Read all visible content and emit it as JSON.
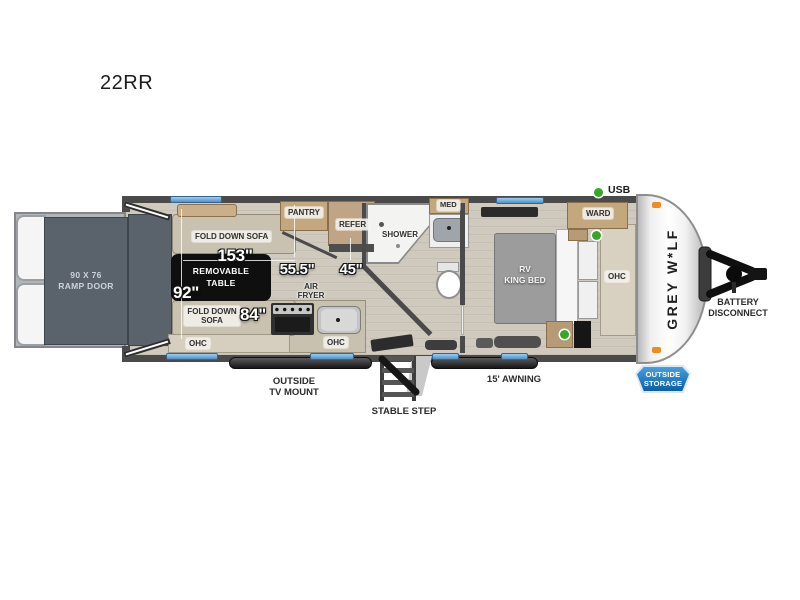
{
  "title": "22RR",
  "colors": {
    "window_blue": "#5f9fd4",
    "usb_green": "#35a829",
    "storage_badge_blue": "#1672c0",
    "marker_orange": "#f08c1e",
    "ramp_panel_gray": "#5a626b",
    "wall_gray": "#4a4a4a"
  },
  "dims": {
    "sofa_top": "153\"",
    "slide": "92\"",
    "sofa_bottom": "84\"",
    "galley": "55.5\"",
    "entry": "45\""
  },
  "living": {
    "sofa_top": "FOLD DOWN SOFA",
    "table_l1": "REMOVABLE",
    "table_l2": "TABLE",
    "sofa_bottom_l1": "FOLD DOWN",
    "sofa_bottom_l2": "SOFA",
    "ohc": "OHC"
  },
  "kitchen": {
    "pantry": "PANTRY",
    "refer": "REFER",
    "air_l1": "AIR",
    "air_l2": "FRYER",
    "ohc": "OHC"
  },
  "bath": {
    "shower": "SHOWER",
    "med": "MED"
  },
  "bedroom": {
    "bed_l1": "RV",
    "bed_l2": "KING BED",
    "ward": "WARD",
    "ohc": "OHC"
  },
  "legend": {
    "usb": "USB"
  },
  "exterior": {
    "ramp_l1": "90 X 76",
    "ramp_l2": "RAMP DOOR",
    "brand": "GREY W*LF",
    "battery_l1": "BATTERY",
    "battery_l2": "DISCONNECT",
    "storage_l1": "OUTSIDE",
    "storage_l2": "STORAGE",
    "tv_l1": "OUTSIDE",
    "tv_l2": "TV MOUNT",
    "step": "STABLE STEP",
    "awning": "15' AWNING"
  }
}
